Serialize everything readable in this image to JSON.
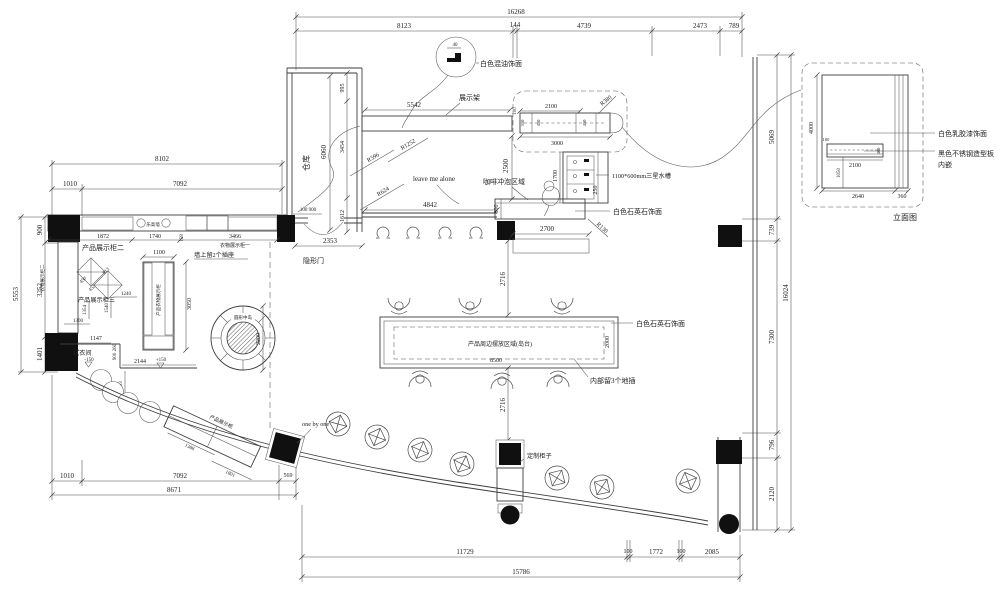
{
  "dims": {
    "top": {
      "overall": "16268",
      "s1": "8123",
      "s2": "144",
      "s3": "4739",
      "s4": "2473",
      "s5": "789"
    },
    "bottom": {
      "overall": "15786",
      "s1": "11729",
      "s2": "100",
      "s3": "1772",
      "s4": "100",
      "s5": "2085"
    },
    "bottom_left": {
      "overall": "8671",
      "s1": "1010",
      "s2": "7092",
      "s3": "569"
    },
    "left": {
      "overall": "5553",
      "s1": "900",
      "s2": "3252",
      "s3": "1401"
    },
    "right": {
      "overall": "16024",
      "s1": "5069",
      "s2": "739",
      "s3": "7300",
      "s4": "796",
      "s5": "2120"
    },
    "top_left": {
      "overall": "8102",
      "s1": "1010",
      "s2": "7092"
    }
  },
  "warehouse": {
    "label": "仓库",
    "d6060": "6060",
    "d995": "995",
    "d3454": "3454",
    "d1612": "1612",
    "door_d": "100 900",
    "dim2353": "2353",
    "hidden_door": "隐形门"
  },
  "bubble": {
    "num": "40",
    "label": "白色混油饰面"
  },
  "rack": {
    "label": "展示架",
    "d5542": "5542",
    "d4842": "4842",
    "r1252": "R1252",
    "r596": "R596",
    "r624": "R624",
    "note": "leave me alone"
  },
  "shelf": {
    "d100": "100",
    "d2100": "2100",
    "d3000": "3000",
    "d350": "350",
    "d450a": "450",
    "d450b": "450",
    "r380": "R380"
  },
  "coffee": {
    "area": "咖啡冲泡区域",
    "d2500": "2500",
    "d1700": "1700",
    "d250": "250",
    "d800": "800",
    "d2700": "2700",
    "r130": "R130",
    "sink": "1100*600mm三星水槽",
    "finish": "白色石英石饰面"
  },
  "island": {
    "area": "产品周边摆放区域(岛台)",
    "d8500": "8500",
    "d2000": "2000",
    "finish": "白色石英石饰面",
    "sockets": "内部留3个地插",
    "d2716a": "2716",
    "d2716b": "2716"
  },
  "round_island": {
    "label": "圆形中岛",
    "d2200": "2200"
  },
  "left_zone": {
    "cab2": "产品展示柜二",
    "cab1": "衣物展示柜一",
    "cab2v": "衣物展示柜二",
    "cab3": "产品展示柜三",
    "lego": "乐高墙",
    "sockets": "墙上留2个插座",
    "d1872": "1872",
    "d1740": "1740",
    "d3466": "3466",
    "d158": "158",
    "d450": "450",
    "d813": "813",
    "d452": "452",
    "d1240": "1240",
    "d1300": "1300",
    "d1354": "1354",
    "d1540": "1540",
    "vcab": "产品衣物展示柜",
    "d1100": "1100",
    "d3050": "3050"
  },
  "fitting": {
    "label": "试衣间",
    "lv_minus": "-150",
    "lv_plus": "+150",
    "d1147": "1147",
    "d2144": "2144",
    "d900260": "900 260",
    "d983": "983"
  },
  "diag_cab": {
    "label": "产品展示柜",
    "d1388": "1388",
    "d1801": "1801"
  },
  "bottom_zone": {
    "note": "one by one",
    "custom": "定制柜子"
  },
  "elevation": {
    "caption": "立面图",
    "finish_wall": "白色乳胶漆饰面",
    "inlay1": "黑色不锈钢造型板",
    "inlay2": "内嵌",
    "d4000": "4000",
    "d100": "100",
    "d2100": "2100",
    "d1050": "1050",
    "d2640": "2640",
    "d360": "360",
    "d400": "400"
  }
}
